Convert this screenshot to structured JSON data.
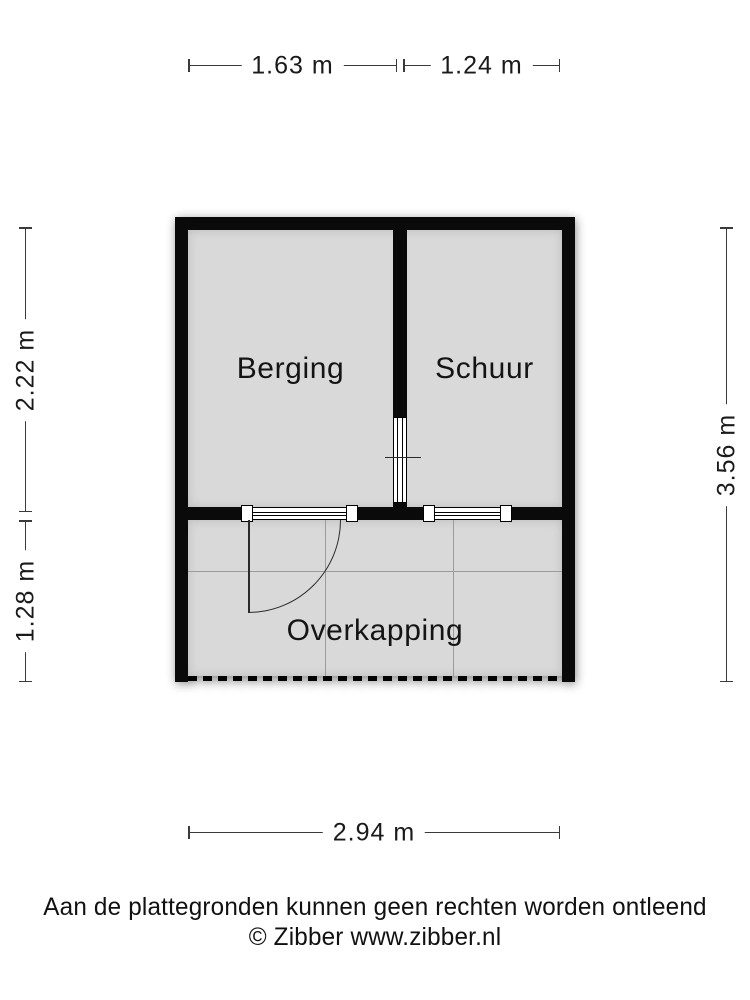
{
  "meta": {
    "type": "floorplan",
    "colors": {
      "wall": "#0a0a0a",
      "floor": "#d9d9d9",
      "grid_line": "#9b9b9b",
      "dimension_line": "#3a3a3a",
      "background": "#ffffff"
    }
  },
  "dimensions": {
    "top_left": {
      "label": "1.63 m"
    },
    "top_right": {
      "label": "1.24 m"
    },
    "left_upper": {
      "label": "2.22 m"
    },
    "left_lower": {
      "label": "1.28 m"
    },
    "right": {
      "label": "3.56 m"
    },
    "bottom": {
      "label": "2.94 m"
    }
  },
  "rooms": {
    "berging": {
      "name": "Berging"
    },
    "schuur": {
      "name": "Schuur"
    },
    "overkapping": {
      "name": "Overkapping"
    }
  },
  "footer": {
    "disclaimer": "Aan de plattegronden kunnen geen rechten worden ontleend",
    "copyright": "© Zibber www.zibber.nl"
  }
}
